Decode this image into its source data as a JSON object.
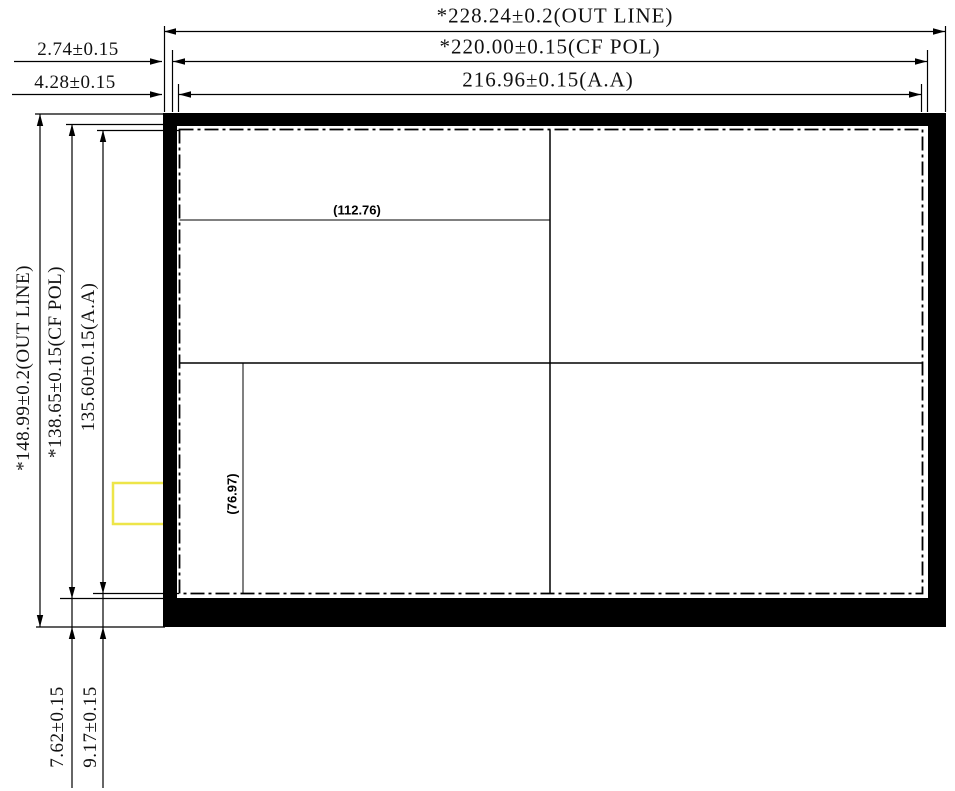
{
  "drawing_title": "LCD panel outline dimension drawing",
  "dimensions": {
    "outline_width": "*228.24±0.2(OUT LINE)",
    "cf_pol_width": "*220.00±0.15(CF POL)",
    "aa_width": "216.96±0.15(A.A)",
    "cf_offset_left": "2.74±0.15",
    "aa_offset_left": "4.28±0.15",
    "outline_height": "*148.99±0.2(OUT LINE)",
    "cf_pol_height": "*138.65±0.15(CF POL)",
    "aa_height": "135.60±0.15(A.A)",
    "cf_offset_bottom": "7.62±0.15",
    "aa_offset_bottom": "9.17±0.15",
    "center_ref_horizontal": "(112.76)",
    "center_ref_vertical": "(76.97)"
  },
  "colors": {
    "line": "#000000",
    "panel_frame": "#000000",
    "highlight_box": "#ede549",
    "background": "#ffffff"
  }
}
